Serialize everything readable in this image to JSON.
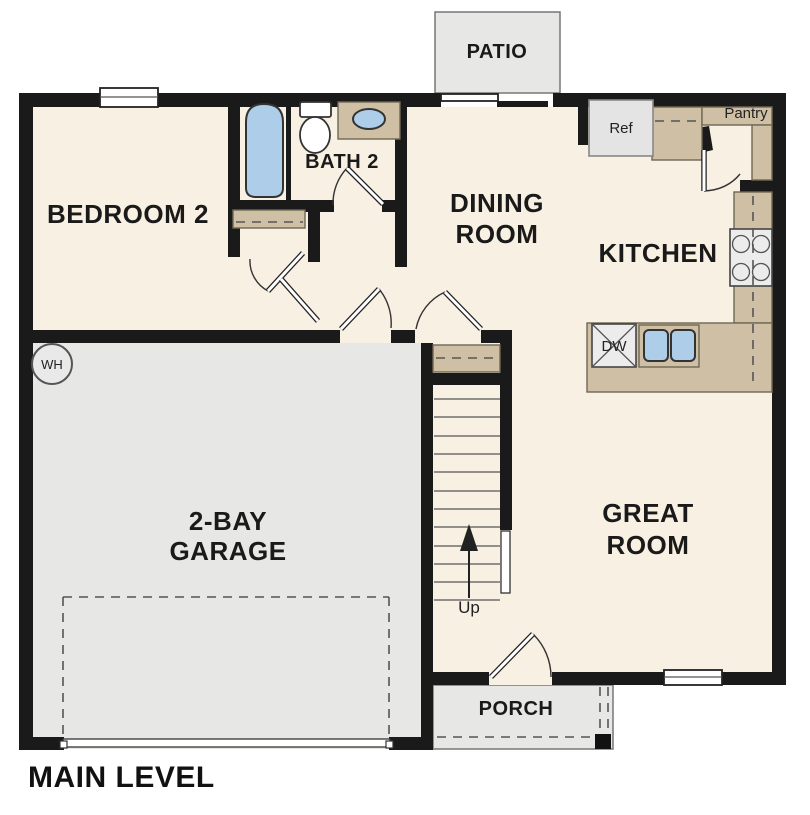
{
  "title": "MAIN LEVEL",
  "rooms": {
    "patio": "PATIO",
    "bedroom2": "BEDROOM 2",
    "bath2": "BATH 2",
    "dining": {
      "line1": "DINING",
      "line2": "ROOM"
    },
    "kitchen": "KITCHEN",
    "great_room": {
      "line1": "GREAT",
      "line2": "ROOM"
    },
    "garage": {
      "line1": "2-BAY",
      "line2": "GARAGE"
    },
    "porch": "PORCH"
  },
  "labels": {
    "refrigerator": "Ref",
    "pantry": "Pantry",
    "dishwasher": "DW",
    "water_heater": "WH",
    "stairs_up": "Up"
  },
  "colors": {
    "wall": "#1a1a1a",
    "floor": "#f8f0e2",
    "cabinet": "#cfc0a5",
    "hardscape": "#e7e7e6",
    "fixture_blue": "#aecde8"
  }
}
